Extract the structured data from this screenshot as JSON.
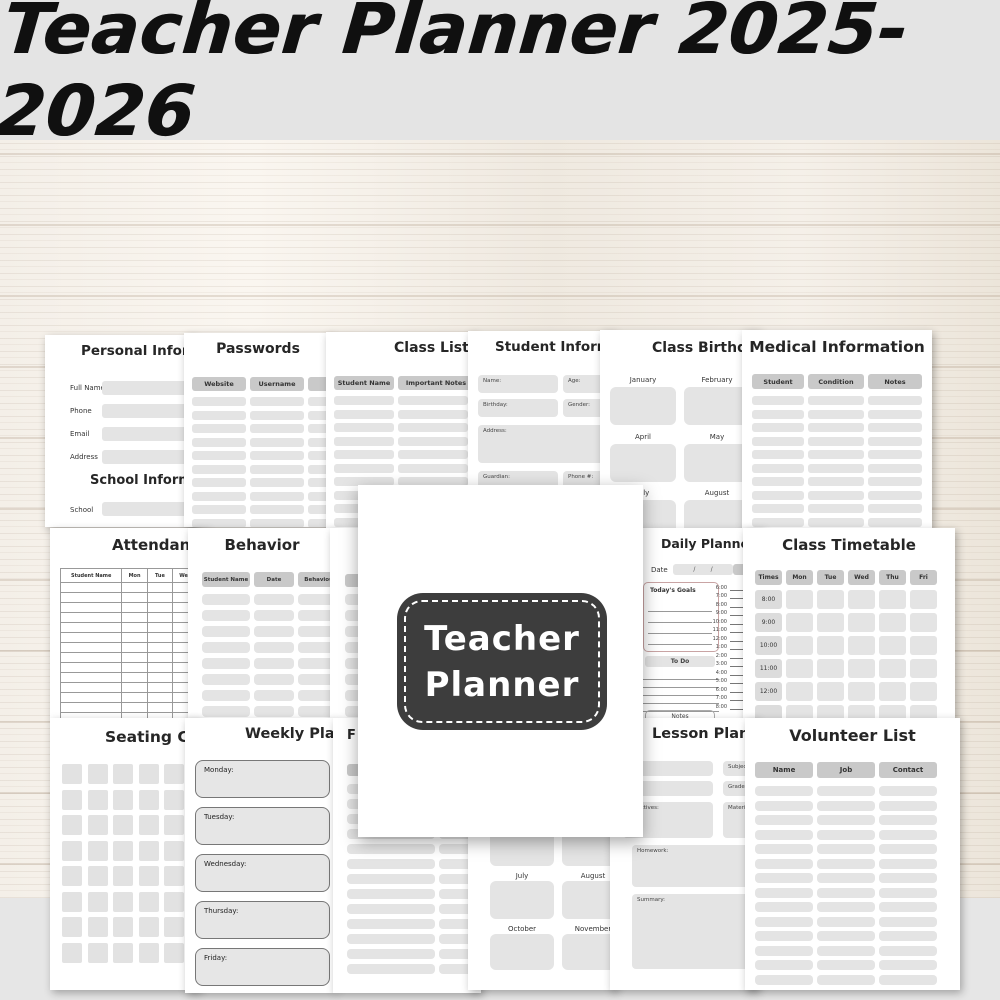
{
  "banner": {
    "title": "Teacher Planner 2025-2026"
  },
  "cover": {
    "line1": "Teacher",
    "line2": "Planner"
  },
  "footer": {
    "format": "PDF Printable",
    "png_count": "40 png",
    "jpg_count": "40 jpg",
    "size": "8.5×11 inches"
  },
  "colors": {
    "banner_bg": "#e4e4e4",
    "wood_base": "#f3eee6",
    "page_bg": "#ffffff",
    "pill": "#e4e4e4",
    "header_pill": "#c9c9c9",
    "cover_board": "#3d3d3d"
  },
  "pages": {
    "personal_information": {
      "title": "Personal Information",
      "fields": [
        "Full Name",
        "Phone",
        "Email",
        "Address"
      ],
      "section2_title": "School Information",
      "school_field": "School"
    },
    "passwords": {
      "title": "Passwords",
      "headers": [
        "Website",
        "Username",
        ""
      ]
    },
    "class_list": {
      "title": "Class List",
      "headers": [
        "Student Name",
        "Important Notes"
      ]
    },
    "student_information": {
      "title": "Student Information",
      "fields": {
        "name": "Name:",
        "age": "Age:",
        "birthday": "Birthday:",
        "gender": "Gender:",
        "address": "Address:",
        "guardian": "Guardian:",
        "phone": "Phone #:"
      }
    },
    "class_birthdays": {
      "title": "Class Birthdays",
      "months": [
        "January",
        "February",
        "April",
        "May",
        "July",
        "August"
      ]
    },
    "medical_information": {
      "title": "Medical Information",
      "headers": [
        "Student",
        "Condition",
        "Notes"
      ]
    },
    "attendance": {
      "title": "Attendance",
      "headers": [
        "Student Name",
        "Mon",
        "Tue",
        "Wed",
        "Thu"
      ]
    },
    "behavior": {
      "title": "Behavior",
      "headers": [
        "Student Name",
        "Date",
        "Behaviour"
      ]
    },
    "daily_planner": {
      "title": "Daily Planner",
      "date_label": "Date",
      "date_value": "/        /",
      "goals_label": "Today's Goals",
      "todo_label": "To Do",
      "notes_label": "Notes",
      "times": [
        "6:00",
        "7:00",
        "8:00",
        "9:00",
        "10:00",
        "11:00",
        "12:00",
        "1:00",
        "2:00",
        "3:00",
        "4:00",
        "5:00",
        "6:00",
        "7:00",
        "8:00"
      ]
    },
    "class_timetable": {
      "title": "Class Timetable",
      "headers": [
        "Times",
        "Mon",
        "Tue",
        "Wed",
        "Thu",
        "Fri"
      ],
      "times": [
        "8:00",
        "9:00",
        "10:00",
        "11:00",
        "12:00"
      ]
    },
    "seating_chart": {
      "title": "Seating Chart"
    },
    "weekly_planner": {
      "title": "Weekly Planner",
      "days": [
        "Monday:",
        "Tuesday:",
        "Wednesday:",
        "Thursday:",
        "Friday:"
      ]
    },
    "partial_page": {
      "title": "F"
    },
    "months_overview": {
      "months": [
        "July",
        "August",
        "October",
        "November"
      ]
    },
    "lesson_plan": {
      "title": "Lesson Plan",
      "fields": {
        "subject": "Subject:",
        "grade": "Grade:",
        "materials": "Materials:",
        "objectives": "Objectives:",
        "homework": "Homework:",
        "summary": "Summary:"
      }
    },
    "volunteer_list": {
      "title": "Volunteer List",
      "headers": [
        "Name",
        "Job",
        "Contact"
      ]
    }
  }
}
